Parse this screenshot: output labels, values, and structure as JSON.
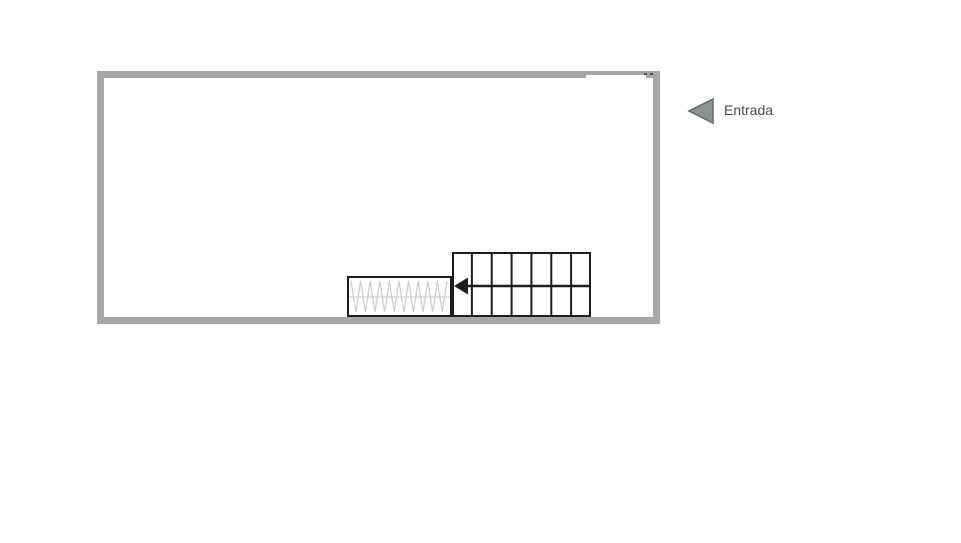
{
  "canvas": {
    "width_px": 961,
    "height_px": 543
  },
  "colors": {
    "background": "#ffffff",
    "wall": "#a6a6a6",
    "line": "#1c1c1c",
    "hatch": "#cccccc",
    "hatch-mid": "#c4c4c4",
    "arrow-fill": "#8d9494",
    "arrow-border": "#5f6969",
    "text": "#4a4a4a",
    "dot": "#4d4d4d"
  },
  "entrance": {
    "label": "Entrada",
    "icon": "left-arrow-triangle-icon"
  },
  "floor_plan": {
    "shape": "rectangular-room-outline",
    "wall_thickness_px": 7,
    "entrance_gap_edge": "top-right",
    "stair_grid": {
      "columns": 7,
      "rows": 2,
      "arrow_direction": "left"
    },
    "ramp": {
      "pattern": "zigzag-hatch",
      "center_line": true
    }
  }
}
